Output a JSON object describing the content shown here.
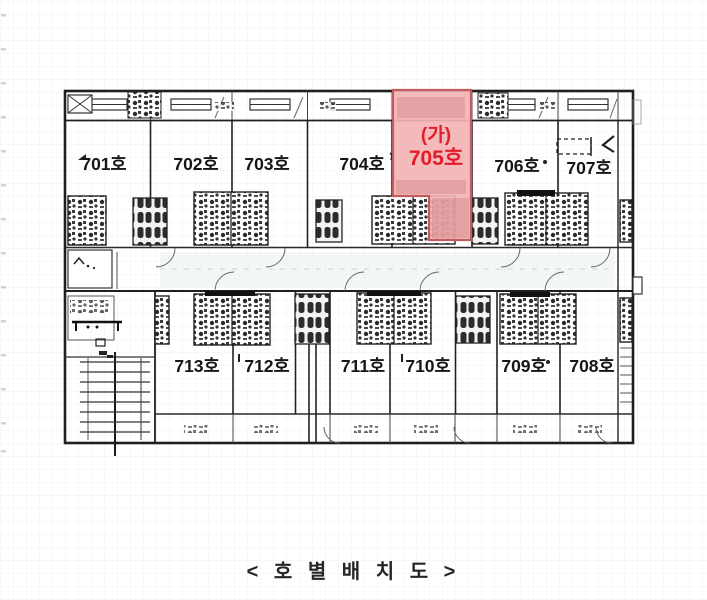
{
  "document": {
    "caption": "< 호 별 배 치 도 >"
  },
  "plan": {
    "highlighted_room": {
      "tag": "(가)",
      "label": "705호",
      "fill": "#f3b3b5",
      "border": "#c05c5c",
      "text_color": "#e01d28"
    },
    "top_row_rooms": [
      {
        "label": "701호"
      },
      {
        "label": "702호"
      },
      {
        "label": "703호"
      },
      {
        "label": "704호"
      },
      {
        "label": "706호"
      },
      {
        "label": "707호"
      }
    ],
    "bottom_row_rooms": [
      {
        "label": "713호"
      },
      {
        "label": "712호"
      },
      {
        "label": "711호"
      },
      {
        "label": "710호"
      },
      {
        "label": "709호"
      },
      {
        "label": "708호"
      }
    ]
  }
}
